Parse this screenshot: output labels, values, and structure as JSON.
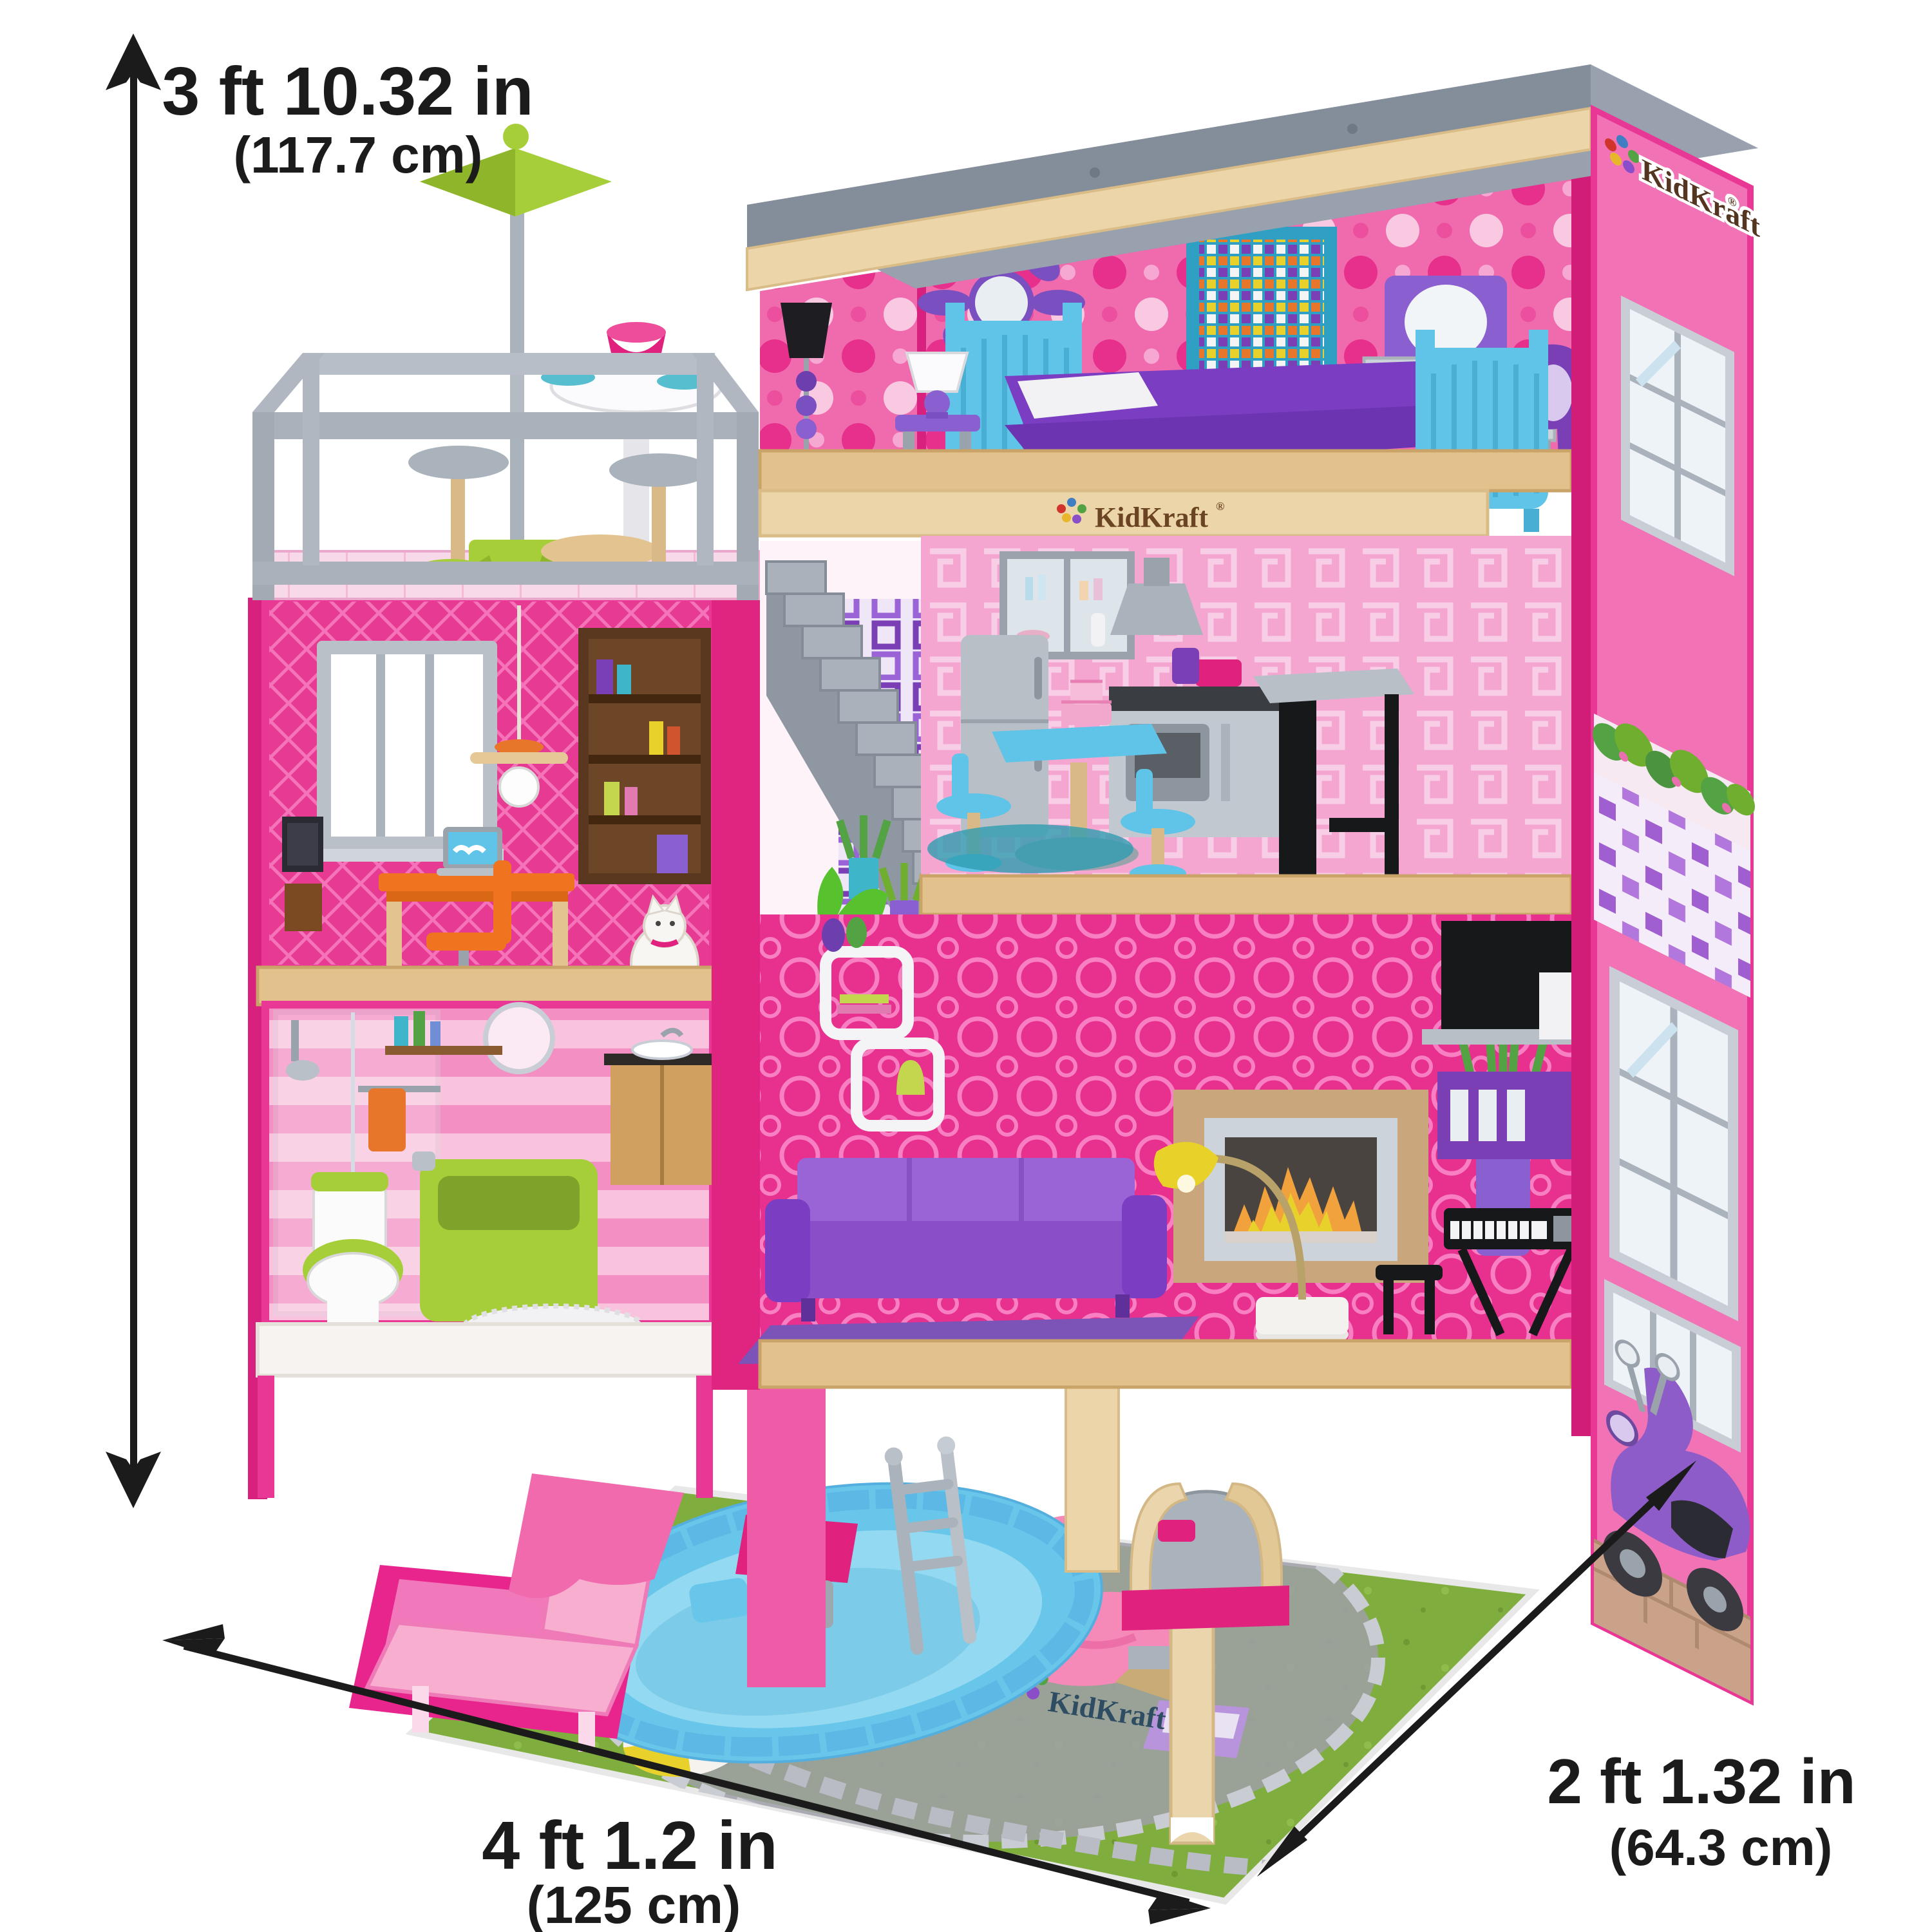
{
  "annotations": {
    "height": {
      "imperial": "3 ft 10.32 in",
      "metric": "(117.7 cm)"
    },
    "width": {
      "imperial": "4 ft 1.2 in",
      "metric": "(125 cm)"
    },
    "depth": {
      "imperial": "2 ft 1.32 in",
      "metric": "(64.3 cm)"
    }
  },
  "brand": {
    "name": "KidKraft",
    "registered": "®"
  },
  "colors": {
    "arrow_black": "#1b1b1b",
    "frame_hot_pink": "#e93795",
    "side_wall_pink": "#f173b6",
    "roof_gray": "#98a1ad",
    "wood_trim": "#ecd5a8",
    "accent_green": "#a6ce39",
    "furniture_blue": "#5fc4e8",
    "furniture_purple": "#8a4fc8",
    "desk_orange": "#f07420",
    "lawn_green": "#7fae3e",
    "pool_blue": "#6cc6ea"
  }
}
